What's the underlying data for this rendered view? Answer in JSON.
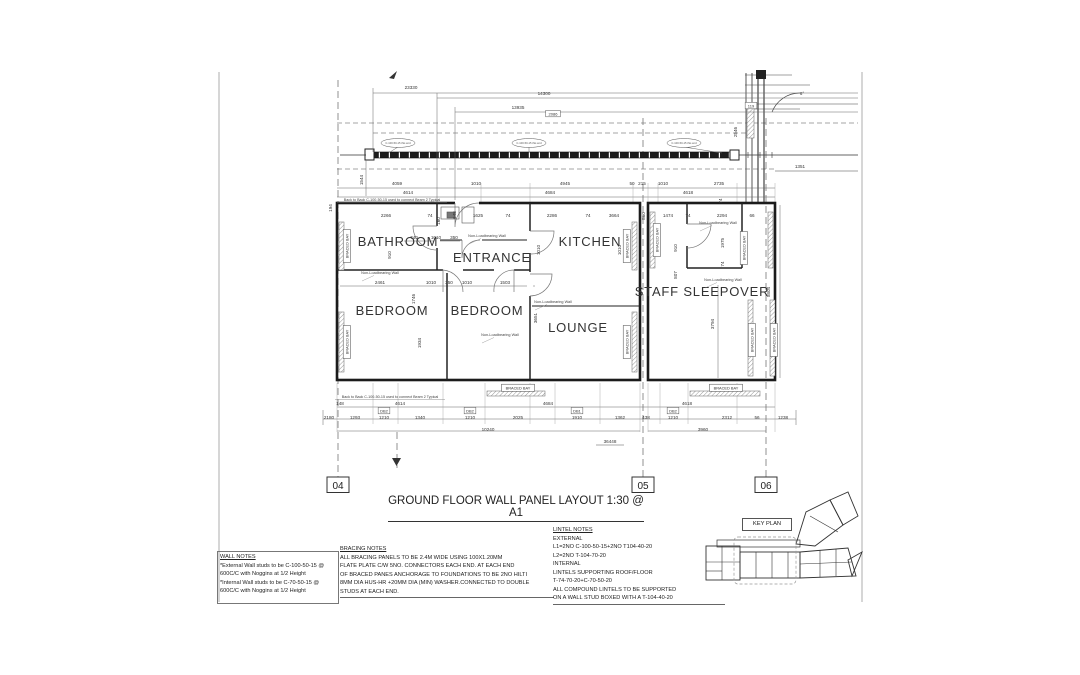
{
  "sheet": {
    "title": "GROUND FLOOR WALL PANEL LAYOUT 1:30 @ A1",
    "key_plan_label": "KEY PLAN",
    "grid_markers": [
      {
        "label": "04",
        "x": 338
      },
      {
        "label": "05",
        "x": 643
      },
      {
        "label": "06",
        "x": 766
      }
    ]
  },
  "plan": {
    "rooms": [
      {
        "label": "BATHROOM",
        "x": 398,
        "y": 246
      },
      {
        "label": "ENTRANCE",
        "x": 492,
        "y": 262
      },
      {
        "label": "KITCHEN",
        "x": 590,
        "y": 246
      },
      {
        "label": "BEDROOM",
        "x": 392,
        "y": 315
      },
      {
        "label": "BEDROOM",
        "x": 487,
        "y": 315
      },
      {
        "label": "LOUNGE",
        "x": 578,
        "y": 332
      },
      {
        "label": "STAFF SLEEPOVER",
        "x": 702,
        "y": 296
      }
    ],
    "dims": [
      {
        "t": "23330",
        "x": 411,
        "y": 89
      },
      {
        "t": "14300",
        "x": 544,
        "y": 95
      },
      {
        "t": "13935",
        "x": 518,
        "y": 109
      },
      {
        "t": "1351",
        "x": 800,
        "y": 168
      },
      {
        "t": "1544",
        "x": 363,
        "y": 180,
        "r": 1
      },
      {
        "t": "2546",
        "x": 737,
        "y": 132,
        "r": 1
      },
      {
        "t": "4059",
        "x": 397,
        "y": 185
      },
      {
        "t": "1010",
        "x": 476,
        "y": 185
      },
      {
        "t": "4945",
        "x": 565,
        "y": 185
      },
      {
        "t": "50",
        "x": 632,
        "y": 185
      },
      {
        "t": "215",
        "x": 642,
        "y": 185
      },
      {
        "t": "1010",
        "x": 663,
        "y": 185
      },
      {
        "t": "2735",
        "x": 719,
        "y": 185
      },
      {
        "t": "4614",
        "x": 408,
        "y": 194
      },
      {
        "t": "4684",
        "x": 550,
        "y": 194
      },
      {
        "t": "4618",
        "x": 688,
        "y": 194
      },
      {
        "t": "74",
        "x": 722,
        "y": 201,
        "r": 1
      },
      {
        "t": "194",
        "x": 332,
        "y": 208,
        "r": 1
      },
      {
        "t": "2266",
        "x": 386,
        "y": 217
      },
      {
        "t": "74",
        "x": 430,
        "y": 217
      },
      {
        "t": "160",
        "x": 440,
        "y": 221,
        "r": 1
      },
      {
        "t": "648",
        "x": 456,
        "y": 215,
        "r": 1
      },
      {
        "t": "1625",
        "x": 478,
        "y": 217
      },
      {
        "t": "74",
        "x": 508,
        "y": 217
      },
      {
        "t": "2286",
        "x": 552,
        "y": 217
      },
      {
        "t": "74",
        "x": 588,
        "y": 217
      },
      {
        "t": "3664",
        "x": 614,
        "y": 217
      },
      {
        "t": "860",
        "x": 645,
        "y": 216,
        "r": 1
      },
      {
        "t": "1474",
        "x": 668,
        "y": 217
      },
      {
        "t": "74",
        "x": 688,
        "y": 217
      },
      {
        "t": "2294",
        "x": 722,
        "y": 217
      },
      {
        "t": "66",
        "x": 752,
        "y": 217
      },
      {
        "t": "740",
        "x": 414,
        "y": 239
      },
      {
        "t": "1010",
        "x": 436,
        "y": 239
      },
      {
        "t": "350",
        "x": 454,
        "y": 239
      },
      {
        "t": "910",
        "x": 391,
        "y": 255,
        "r": 1
      },
      {
        "t": "1010",
        "x": 540,
        "y": 250,
        "r": 1
      },
      {
        "t": "1010",
        "x": 621,
        "y": 250,
        "r": 1
      },
      {
        "t": "2461",
        "x": 380,
        "y": 284
      },
      {
        "t": "1010",
        "x": 431,
        "y": 284
      },
      {
        "t": "350",
        "x": 449,
        "y": 284
      },
      {
        "t": "1010",
        "x": 467,
        "y": 284
      },
      {
        "t": "1503",
        "x": 505,
        "y": 284
      },
      {
        "t": "1746",
        "x": 415,
        "y": 299,
        "r": 1
      },
      {
        "t": "1934",
        "x": 421,
        "y": 343,
        "r": 1
      },
      {
        "t": "3651",
        "x": 537,
        "y": 318,
        "r": 1
      },
      {
        "t": "910",
        "x": 677,
        "y": 248,
        "r": 1
      },
      {
        "t": "807",
        "x": 677,
        "y": 275,
        "r": 1
      },
      {
        "t": "1975",
        "x": 724,
        "y": 243,
        "r": 1
      },
      {
        "t": "74",
        "x": 724,
        "y": 264,
        "r": 1
      },
      {
        "t": "3794",
        "x": 714,
        "y": 324,
        "r": 1
      },
      {
        "t": "5804",
        "x": 770,
        "y": 292,
        "r": 1
      },
      {
        "t": "148",
        "x": 340,
        "y": 405
      },
      {
        "t": "4614",
        "x": 400,
        "y": 405
      },
      {
        "t": "4684",
        "x": 548,
        "y": 405
      },
      {
        "t": "4618",
        "x": 687,
        "y": 405
      },
      {
        "t": "2180",
        "x": 329,
        "y": 419
      },
      {
        "t": "1293",
        "x": 355,
        "y": 419
      },
      {
        "t": "1210",
        "x": 384,
        "y": 419
      },
      {
        "t": "1340",
        "x": 420,
        "y": 419
      },
      {
        "t": "1210",
        "x": 470,
        "y": 419
      },
      {
        "t": "2025",
        "x": 518,
        "y": 419
      },
      {
        "t": "1910",
        "x": 577,
        "y": 419
      },
      {
        "t": "1362",
        "x": 620,
        "y": 419
      },
      {
        "t": "438",
        "x": 646,
        "y": 419
      },
      {
        "t": "1210",
        "x": 673,
        "y": 419
      },
      {
        "t": "2312",
        "x": 727,
        "y": 419
      },
      {
        "t": "56",
        "x": 757,
        "y": 419
      },
      {
        "t": "1238",
        "x": 783,
        "y": 419
      },
      {
        "t": "10240",
        "x": 488,
        "y": 431
      },
      {
        "t": "3960",
        "x": 703,
        "y": 431
      },
      {
        "t": "36448",
        "x": 610,
        "y": 443,
        "u": 1
      }
    ],
    "tags": [
      {
        "t": "119",
        "x": 751,
        "y": 107
      },
      {
        "t": "2086",
        "x": 553,
        "y": 115
      },
      {
        "t": "DB2",
        "x": 384,
        "y": 412
      },
      {
        "t": "DB2",
        "x": 470,
        "y": 412
      },
      {
        "t": "DB1",
        "x": 577,
        "y": 412
      },
      {
        "t": "DB2",
        "x": 673,
        "y": 412
      }
    ],
    "braced_bay": {
      "label": "BRACED BAY",
      "horizontal": [
        {
          "x": 518,
          "y": 388
        },
        {
          "x": 726,
          "y": 388
        }
      ],
      "vertical": [
        {
          "x": 347,
          "y": 246
        },
        {
          "x": 347,
          "y": 342
        },
        {
          "x": 627,
          "y": 246
        },
        {
          "x": 627,
          "y": 342
        },
        {
          "x": 657,
          "y": 240
        },
        {
          "x": 744,
          "y": 248
        },
        {
          "x": 752,
          "y": 340
        },
        {
          "x": 774,
          "y": 340
        }
      ]
    },
    "nlw_label": "Non-Loadbearing Wall",
    "nlw": [
      {
        "x": 487,
        "y": 237
      },
      {
        "x": 380,
        "y": 274
      },
      {
        "x": 500,
        "y": 336
      },
      {
        "x": 553,
        "y": 303
      },
      {
        "x": 718,
        "y": 224
      },
      {
        "x": 723,
        "y": 281
      }
    ],
    "beam_note": "Back to Back C-100-50-15 used to connect Beam 2 Typical",
    "beam_note_pos": [
      {
        "x": 392,
        "y": 201
      },
      {
        "x": 390,
        "y": 398
      }
    ],
    "callout_label": "C-100-50-15 this end",
    "callouts": [
      {
        "x": 398,
        "y": 143
      },
      {
        "x": 529,
        "y": 143
      },
      {
        "x": 684,
        "y": 143
      }
    ],
    "angle_label": "6°"
  },
  "notes": {
    "wall": {
      "title": "WALL NOTES",
      "lines": [
        "*External Wall studs to be C-100-50-15 @",
        "600C/C with Noggins at 1/2 Height",
        "*Internal Wall studs to be C-70-50-15 @",
        "600C/C with Noggins at 1/2 Height"
      ]
    },
    "bracing": {
      "title": "BRACING NOTES",
      "lines": [
        "ALL BRACING PANELS TO BE 2.4M WIDE USING 100X1.20MM",
        "FLATE PLATE C/W 5NO. CONNECTORS EACH END. AT EACH END",
        "OF BRACED PANES ANCHORAGE TO FOUNDATIONS TO BE 2NO HILTI",
        "8MM DIA HUS-HR +20MM DIA (MIN) WASHER.CONNECTED TO DOUBLE",
        "STUDS AT EACH END."
      ]
    },
    "lintel": {
      "title": "LINTEL NOTES",
      "lines": [
        "EXTERNAL",
        "L1=2NO C-100-50-15+2NO T104-40-20",
        "L2=2NO T-104-70-20",
        "INTERNAL",
        "LINTELS SUPPORTING ROOF/FLOOR",
        "T-74-70-20+C-70-50-20",
        "ALL COMPOUND LINTELS TO BE SUPPORTED",
        "ON A WALL STUD BOXED WITH A T-104-40-20"
      ]
    }
  }
}
